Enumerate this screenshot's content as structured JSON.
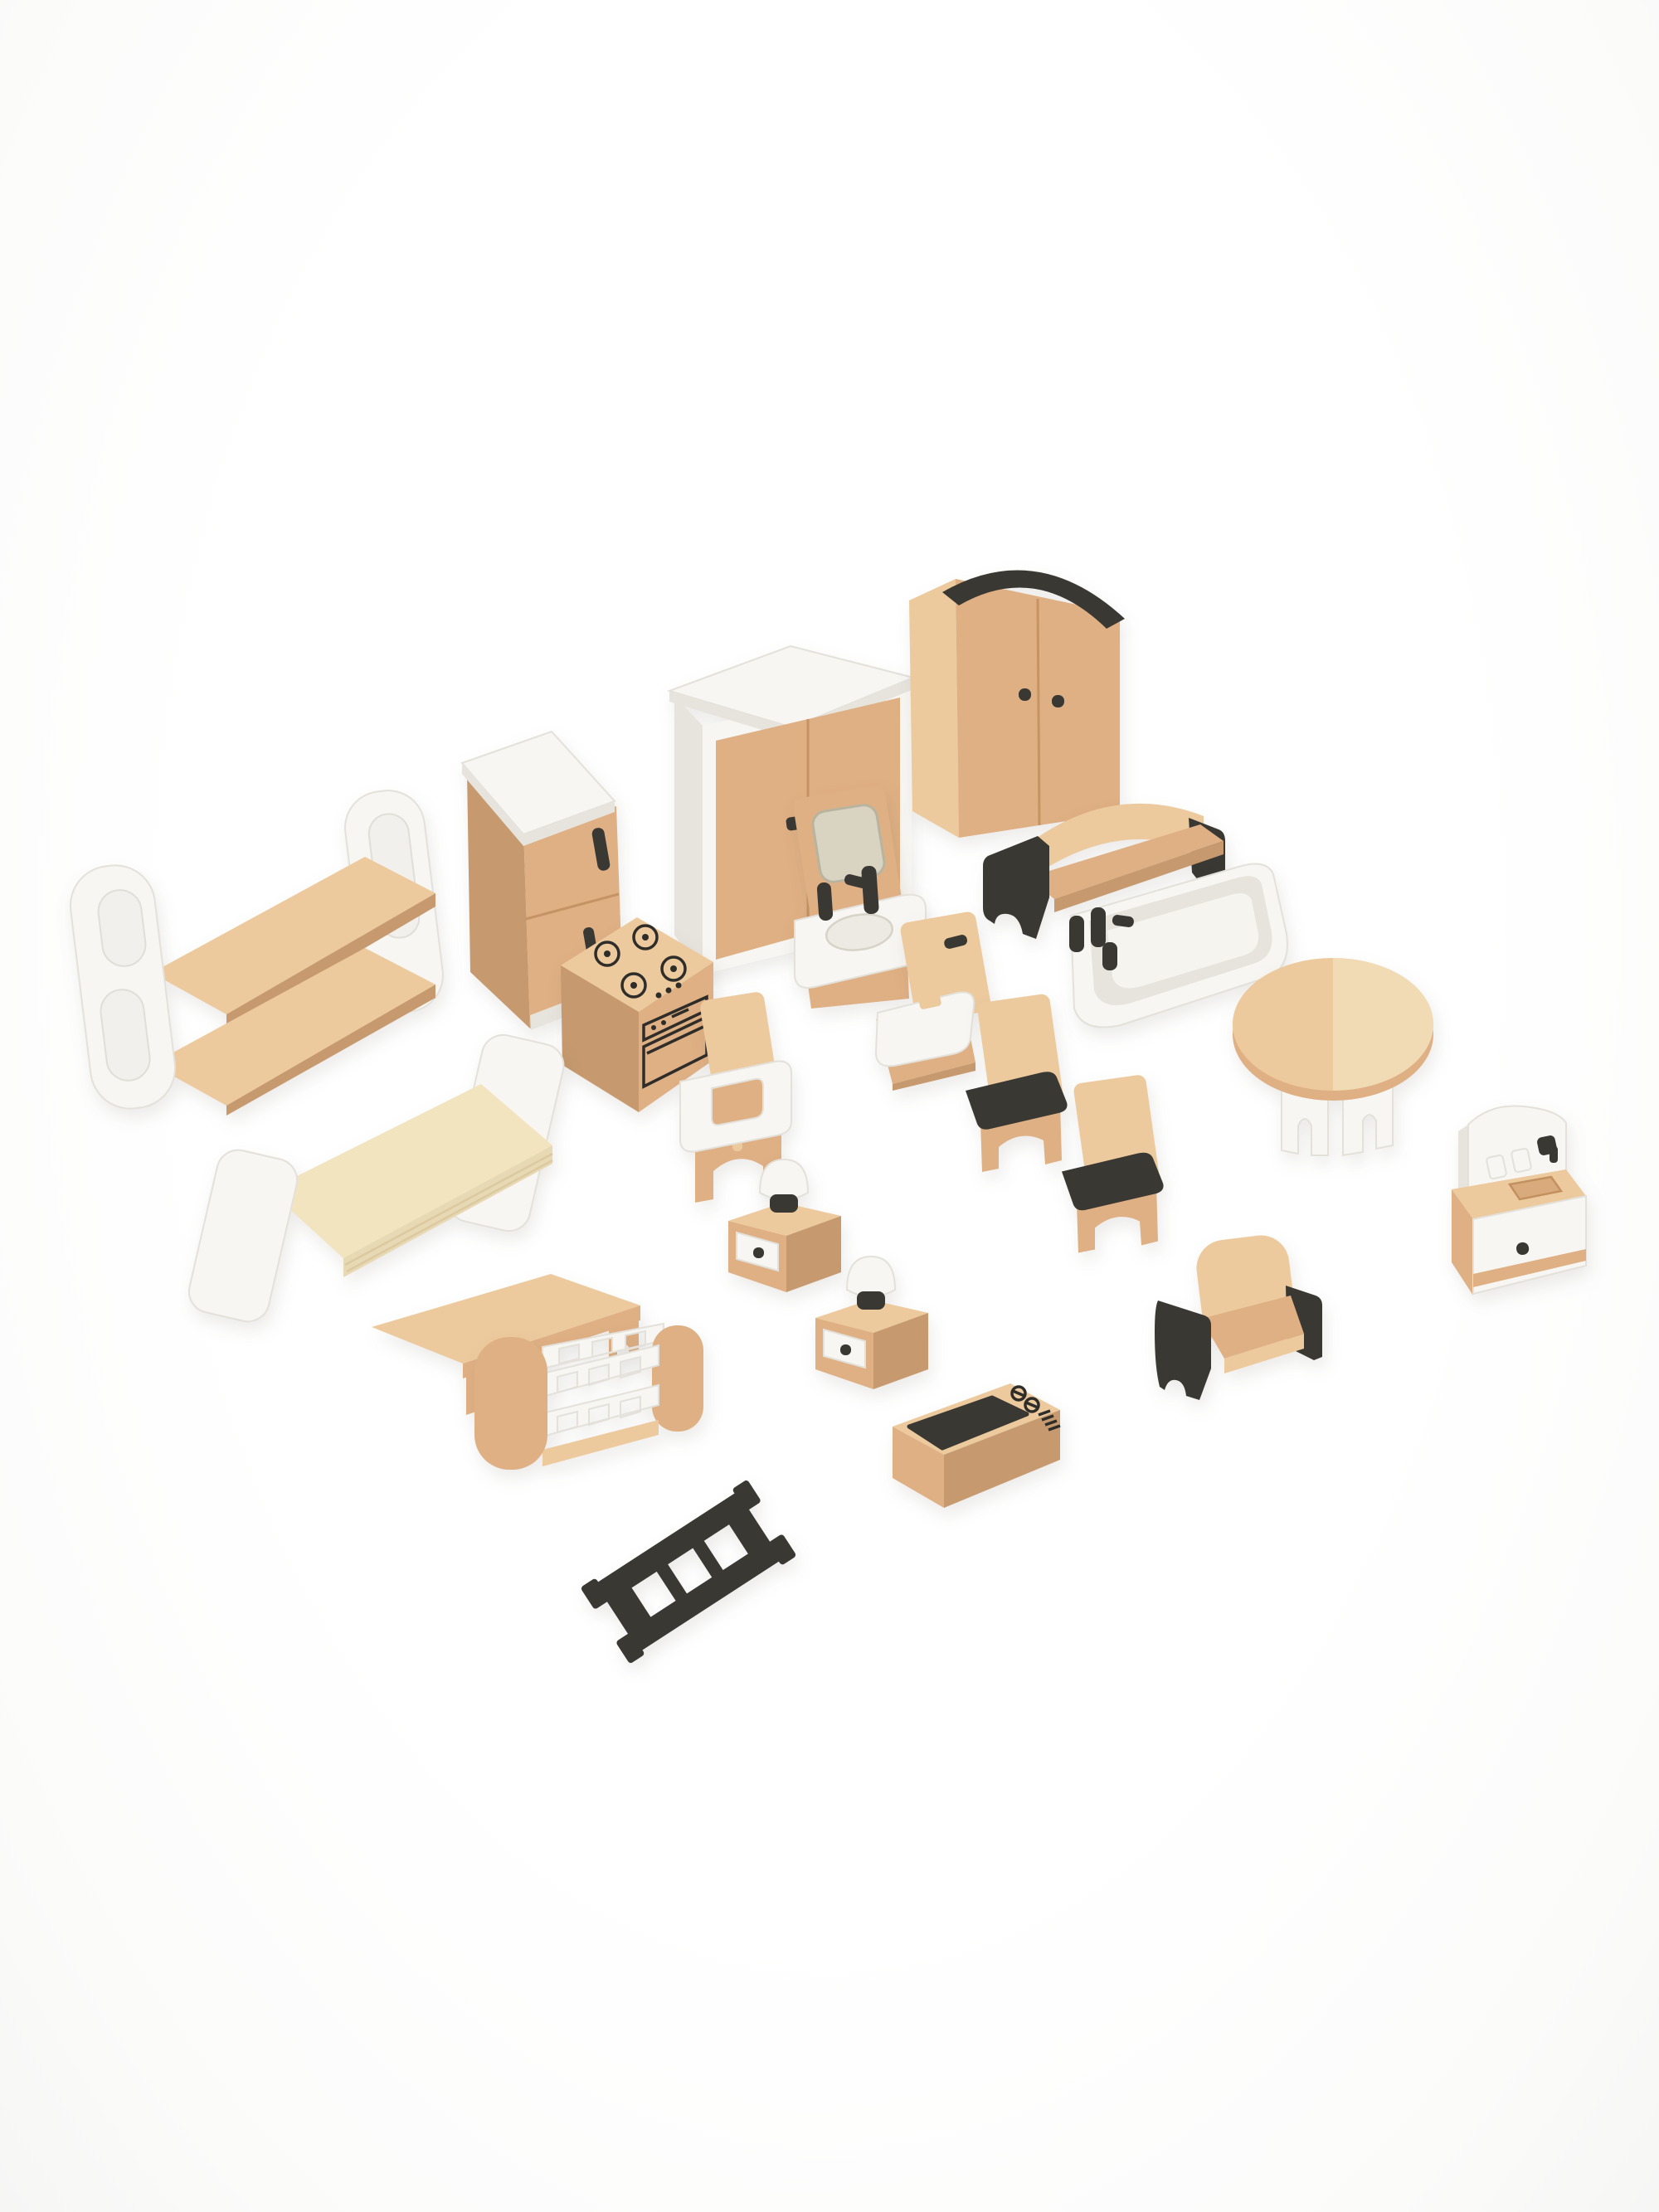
{
  "scene": {
    "type": "product-photo",
    "subject": "Wooden dollhouse miniature furniture play set arranged diagonally on a plain white studio background",
    "piece_count": 22,
    "background": "#ffffff",
    "colors": {
      "wood": "#dfb084",
      "wood-light": "#ecca9d",
      "wood-pale": "#f3e4c0",
      "wood-dark": "#c69a6e",
      "white": "#f7f6f2",
      "white-shade": "#e6e4dd",
      "black": "#3a3833",
      "mirror": "#d9d4c2",
      "hole": "#f1f0ec",
      "seam": "#c49465",
      "print": "#2f2d29"
    }
  },
  "items": [
    {
      "id": "bunk-bed",
      "label": "Bunk bed with white side frames and two wood platforms"
    },
    {
      "id": "fridge",
      "label": "Refrigerator with white top, wood doors and black handles"
    },
    {
      "id": "wardrobe-white",
      "label": "Wardrobe with white frame and double wood doors"
    },
    {
      "id": "wardrobe-dark",
      "label": "Wardrobe with black arched top trim and double doors"
    },
    {
      "id": "sink-mirror",
      "label": "Washbasin with mirror and black faucet"
    },
    {
      "id": "sofa",
      "label": "Sofa bench with curved wood back and black end panels"
    },
    {
      "id": "bathtub",
      "label": "White bathtub with black faucet knobs"
    },
    {
      "id": "toilet",
      "label": "Toilet with wood tank and white seat"
    },
    {
      "id": "stove",
      "label": "Kitchen stove with four printed burners and oven front"
    },
    {
      "id": "high-chair",
      "label": "High chair with white feeding tray"
    },
    {
      "id": "dining-chair-1",
      "label": "Dining chair with black seat"
    },
    {
      "id": "dining-chair-2",
      "label": "Dining chair with black seat"
    },
    {
      "id": "round-table",
      "label": "Round dining table with white arched legs"
    },
    {
      "id": "kitchen-sink",
      "label": "Kitchen sink cabinet with white backsplash, faucet and door"
    },
    {
      "id": "bed",
      "label": "Bed with white headboard and footboard and pale wood base"
    },
    {
      "id": "coffee-table",
      "label": "Low wooden coffee table"
    },
    {
      "id": "crib",
      "label": "Baby crib with rounded wood ends and white slatted rails"
    },
    {
      "id": "nightstand-1",
      "label": "Nightstand with white drawer and mushroom table lamp"
    },
    {
      "id": "nightstand-2",
      "label": "Nightstand with white drawer and mushroom table lamp"
    },
    {
      "id": "tv",
      "label": "Television with black screen and printed dials"
    },
    {
      "id": "armchair",
      "label": "Armchair with wood seat and black armrests"
    },
    {
      "id": "ladder",
      "label": "Black dollhouse ladder with four rungs"
    }
  ]
}
